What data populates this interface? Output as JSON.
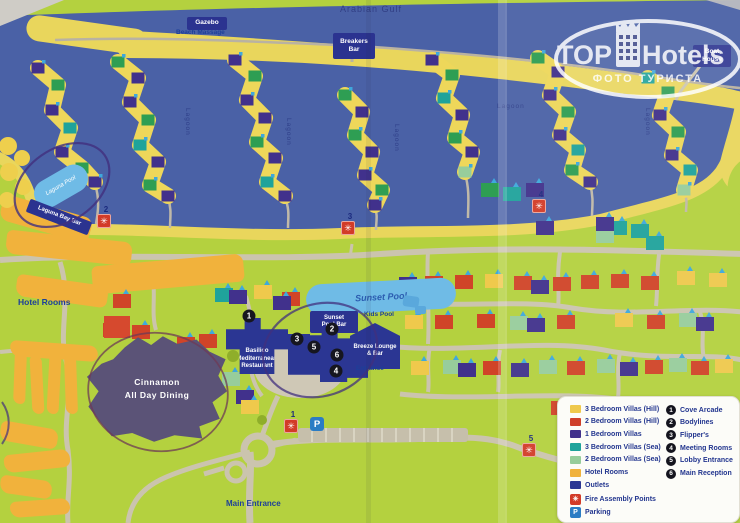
{
  "watermark": {
    "brand_left": "TOP",
    "brand_right": "Hotels",
    "subtitle": "ФОТО ТУРИСТА"
  },
  "sea_label": "Arabian Gulf",
  "poi": {
    "gazebo": "Gazebo",
    "beach_massage": "Beach Massage",
    "breakers_bar": "Breakers Bar",
    "boat_house": "Boat House",
    "sunset_pool_bar": "Sunset Pool Bar",
    "laguna_bay_bar": "Laguna Bay Bar"
  },
  "areas": {
    "hotel_rooms": "Hotel Rooms",
    "main_entrance": "Main Entrance",
    "entrance": "Entrance",
    "kids_pool": "Kids Pool",
    "lagoon": "Lagoon"
  },
  "pools": {
    "laguna": "Laguna Pool",
    "sunset": "Sunset Pool"
  },
  "venues": {
    "basilico": "Basilico Mediterranean Restaurant",
    "breeze": "Breeze Lounge & Bar",
    "cinnamon_line1": "Cinnamon",
    "cinnamon_line2": "All Day Dining"
  },
  "markers": {
    "numbered": [
      {
        "n": "1",
        "x": 249,
        "y": 316
      },
      {
        "n": "2",
        "x": 332,
        "y": 329
      },
      {
        "n": "3",
        "x": 297,
        "y": 339
      },
      {
        "n": "4",
        "x": 336,
        "y": 371
      },
      {
        "n": "5",
        "x": 314,
        "y": 347
      },
      {
        "n": "6",
        "x": 337,
        "y": 355
      }
    ],
    "fire": [
      {
        "n": "1",
        "x": 291,
        "y": 426
      },
      {
        "n": "2",
        "x": 104,
        "y": 221
      },
      {
        "n": "3",
        "x": 348,
        "y": 228
      },
      {
        "n": "4",
        "x": 539,
        "y": 206
      },
      {
        "n": "5",
        "x": 529,
        "y": 450
      }
    ],
    "fire_glyph": "✳",
    "parking": {
      "x": 317,
      "y": 424,
      "label": "P"
    }
  },
  "lagoon_labels": [
    {
      "x": 191,
      "y": 108,
      "vertical": true
    },
    {
      "x": 292,
      "y": 118,
      "vertical": true
    },
    {
      "x": 400,
      "y": 124,
      "vertical": true
    },
    {
      "x": 497,
      "y": 103,
      "vertical": false
    },
    {
      "x": 651,
      "y": 108,
      "vertical": true
    }
  ],
  "legend": {
    "items": [
      {
        "type": "swatch",
        "color": "#efc94c",
        "label": "3 Bedroom Villas (Hill)"
      },
      {
        "type": "swatch",
        "color": "#cf3f2a",
        "label": "2 Bedroom Villas (Hill)"
      },
      {
        "type": "swatch",
        "color": "#41318c",
        "label": "1 Bedroom Villas"
      },
      {
        "type": "swatch",
        "color": "#1fa39b",
        "label": "3 Bedroom Villas (Sea)"
      },
      {
        "type": "swatch",
        "color": "#97cd9b",
        "label": "2 Bedroom Villas (Sea)"
      },
      {
        "type": "swatch",
        "color": "#f0b23c",
        "label": "Hotel Rooms"
      },
      {
        "type": "swatch",
        "color": "#2b3693",
        "label": "Outlets"
      },
      {
        "type": "fire",
        "label": "Fire Assembly Points"
      },
      {
        "type": "parking",
        "label": "Parking"
      }
    ],
    "numbered": [
      {
        "n": "1",
        "label": "Cove Arcade"
      },
      {
        "n": "2",
        "label": "Bodylines"
      },
      {
        "n": "3",
        "label": "Flipper's"
      },
      {
        "n": "4",
        "label": "Meeting Rooms"
      },
      {
        "n": "5",
        "label": "Lobby Entrance"
      },
      {
        "n": "6",
        "label": "Main Reception"
      }
    ]
  },
  "map_decor": {
    "clusters": [
      {
        "pts": [
          [
            38,
            68
          ],
          [
            58,
            85
          ],
          [
            52,
            110
          ],
          [
            70,
            128
          ],
          [
            62,
            152
          ],
          [
            82,
            168
          ],
          [
            95,
            182
          ]
        ],
        "colors": [
          "purple",
          "green",
          "purple",
          "teal",
          "purple",
          "green",
          "purple"
        ]
      },
      {
        "pts": [
          [
            118,
            62
          ],
          [
            138,
            78
          ],
          [
            130,
            102
          ],
          [
            148,
            120
          ],
          [
            140,
            145
          ],
          [
            158,
            162
          ],
          [
            150,
            185
          ],
          [
            168,
            196
          ]
        ],
        "colors": [
          "green",
          "purple",
          "purple",
          "green",
          "teal",
          "purple",
          "green",
          "purple"
        ]
      },
      {
        "pts": [
          [
            235,
            60
          ],
          [
            255,
            76
          ],
          [
            247,
            100
          ],
          [
            265,
            118
          ],
          [
            257,
            142
          ],
          [
            275,
            158
          ],
          [
            267,
            182
          ],
          [
            285,
            196
          ]
        ],
        "colors": [
          "purple",
          "green",
          "purple",
          "purple",
          "green",
          "purple",
          "teal",
          "purple"
        ]
      },
      {
        "pts": [
          [
            345,
            95
          ],
          [
            362,
            112
          ],
          [
            355,
            135
          ],
          [
            372,
            152
          ],
          [
            365,
            175
          ],
          [
            382,
            190
          ],
          [
            375,
            205
          ]
        ],
        "colors": [
          "green",
          "purple",
          "green",
          "purple",
          "purple",
          "green",
          "purple"
        ]
      },
      {
        "pts": [
          [
            432,
            60
          ],
          [
            452,
            75
          ],
          [
            444,
            98
          ],
          [
            462,
            115
          ],
          [
            455,
            138
          ],
          [
            472,
            152
          ],
          [
            465,
            172
          ]
        ],
        "colors": [
          "purple",
          "green",
          "teal",
          "purple",
          "green",
          "purple",
          "lightgreen"
        ]
      },
      {
        "pts": [
          [
            538,
            58
          ],
          [
            558,
            72
          ],
          [
            550,
            95
          ],
          [
            568,
            112
          ],
          [
            560,
            135
          ],
          [
            578,
            150
          ],
          [
            572,
            170
          ],
          [
            590,
            182
          ]
        ],
        "colors": [
          "green",
          "purple",
          "purple",
          "green",
          "purple",
          "teal",
          "green",
          "purple"
        ]
      },
      {
        "pts": [
          [
            648,
            78
          ],
          [
            668,
            92
          ],
          [
            660,
            115
          ],
          [
            678,
            132
          ],
          [
            672,
            155
          ],
          [
            690,
            170
          ],
          [
            684,
            190
          ]
        ],
        "colors": [
          "teal",
          "green",
          "purple",
          "green",
          "purple",
          "teal",
          "lightgreen"
        ]
      }
    ],
    "hill_houses": [
      [
        "purple",
        408,
        284
      ],
      [
        "red",
        434,
        283
      ],
      [
        "red",
        464,
        282
      ],
      [
        "yellow",
        494,
        281
      ],
      [
        "red",
        523,
        283
      ],
      [
        "purple",
        540,
        287
      ],
      [
        "red",
        562,
        284
      ],
      [
        "red",
        590,
        282
      ],
      [
        "red",
        620,
        281
      ],
      [
        "red",
        650,
        283
      ],
      [
        "yellow",
        686,
        278
      ],
      [
        "yellow",
        718,
        280
      ],
      [
        "yellow",
        414,
        322
      ],
      [
        "red",
        444,
        322
      ],
      [
        "red",
        486,
        321
      ],
      [
        "lightgreen",
        519,
        323
      ],
      [
        "purple",
        536,
        325
      ],
      [
        "red",
        566,
        322
      ],
      [
        "yellow",
        624,
        320
      ],
      [
        "red",
        656,
        322
      ],
      [
        "lightgreen",
        688,
        320
      ],
      [
        "purple",
        705,
        324
      ],
      [
        "yellow",
        420,
        368
      ],
      [
        "lightgreen",
        452,
        367
      ],
      [
        "purple",
        467,
        370
      ],
      [
        "red",
        492,
        368
      ],
      [
        "purple",
        520,
        370
      ],
      [
        "lightgreen",
        548,
        367
      ],
      [
        "red",
        576,
        368
      ],
      [
        "lightgreen",
        606,
        366
      ],
      [
        "purple",
        629,
        369
      ],
      [
        "red",
        654,
        367
      ],
      [
        "lightgreen",
        678,
        365
      ],
      [
        "red",
        700,
        368
      ],
      [
        "yellow",
        724,
        366
      ],
      [
        "lightgreen",
        598,
        412
      ],
      [
        "red",
        636,
        419
      ],
      [
        "purple",
        664,
        427
      ],
      [
        "yellow",
        710,
        428
      ],
      [
        "red",
        560,
        408
      ],
      [
        "teal",
        618,
        228
      ],
      [
        "teal",
        640,
        231
      ],
      [
        "lightgreen",
        605,
        236
      ],
      [
        "purple",
        545,
        228
      ],
      [
        "purple",
        605,
        224
      ],
      [
        "purple",
        535,
        190
      ],
      [
        "teal",
        512,
        194
      ],
      [
        "green",
        490,
        190
      ],
      [
        "teal",
        655,
        243
      ],
      [
        "red",
        112,
        330
      ],
      [
        "red",
        141,
        332
      ],
      [
        "red",
        186,
        344
      ],
      [
        "red",
        208,
        341
      ],
      [
        "red",
        122,
        301
      ],
      [
        "teal",
        224,
        295
      ],
      [
        "purple",
        238,
        297
      ],
      [
        "yellow",
        263,
        292
      ],
      [
        "red",
        291,
        299
      ],
      [
        "yellow",
        201,
        381
      ],
      [
        "lightgreen",
        231,
        379
      ],
      [
        "purple",
        245,
        397
      ],
      [
        "yellow",
        250,
        407
      ],
      [
        "purple",
        282,
        303
      ]
    ],
    "hotel_blocks": [
      [
        0,
        206,
        92,
        26,
        16
      ],
      [
        6,
        236,
        126,
        24,
        6
      ],
      [
        92,
        260,
        152,
        28,
        -5
      ],
      [
        16,
        280,
        92,
        22,
        8
      ],
      [
        10,
        343,
        88,
        16,
        4
      ],
      [
        14,
        352,
        12,
        52,
        2
      ],
      [
        31,
        356,
        12,
        58,
        -3
      ],
      [
        48,
        354,
        12,
        60,
        3
      ],
      [
        65,
        356,
        12,
        58,
        -2
      ],
      [
        0,
        425,
        58,
        20,
        10
      ],
      [
        4,
        452,
        66,
        18,
        -6
      ],
      [
        0,
        478,
        52,
        18,
        8
      ],
      [
        10,
        500,
        60,
        16,
        -4
      ]
    ],
    "trees_yellow": [
      [
        8,
        146,
        9
      ],
      [
        22,
        158,
        8
      ],
      [
        9,
        172,
        9
      ],
      [
        23,
        187,
        8
      ],
      [
        7,
        200,
        8
      ]
    ],
    "trees_green": [
      [
        233,
        356,
        6
      ],
      [
        320,
        296,
        5
      ],
      [
        262,
        420,
        5
      ],
      [
        424,
        302,
        4
      ]
    ]
  },
  "palette": {
    "purple": "#41318c",
    "red": "#d04428",
    "yellow": "#efc94c",
    "lightgreen": "#97cd9b",
    "teal": "#1fa39b",
    "green": "#2e9e53",
    "orange": "#f0a93c"
  }
}
